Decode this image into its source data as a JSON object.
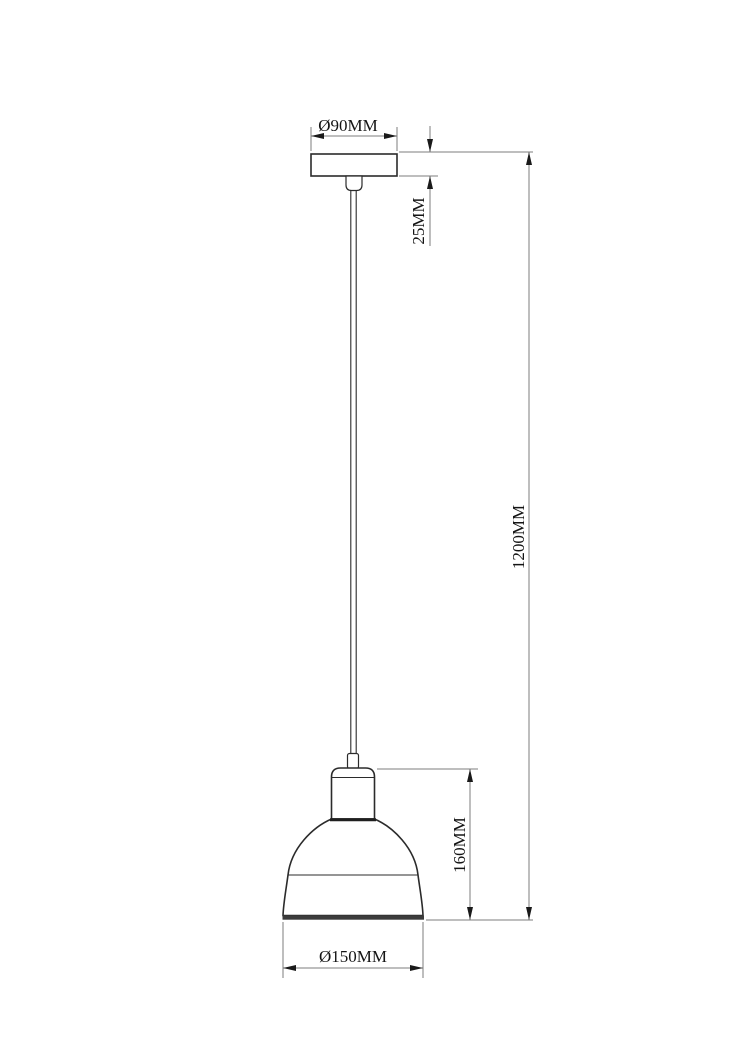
{
  "title": "Pendant lamp technical dimension drawing",
  "drawing": {
    "dimensions": {
      "canopy_diameter": "Ø90MM",
      "canopy_height": "25MM",
      "suspension_length": "1200MM",
      "shade_height": "160MM",
      "shade_diameter": "Ø150MM"
    },
    "colors": {
      "background": "#ffffff",
      "part_outline": "#2b2b2b",
      "dimension_line": "#7d7d7d",
      "arrow": "#1a1a1a",
      "text": "#141414"
    }
  }
}
